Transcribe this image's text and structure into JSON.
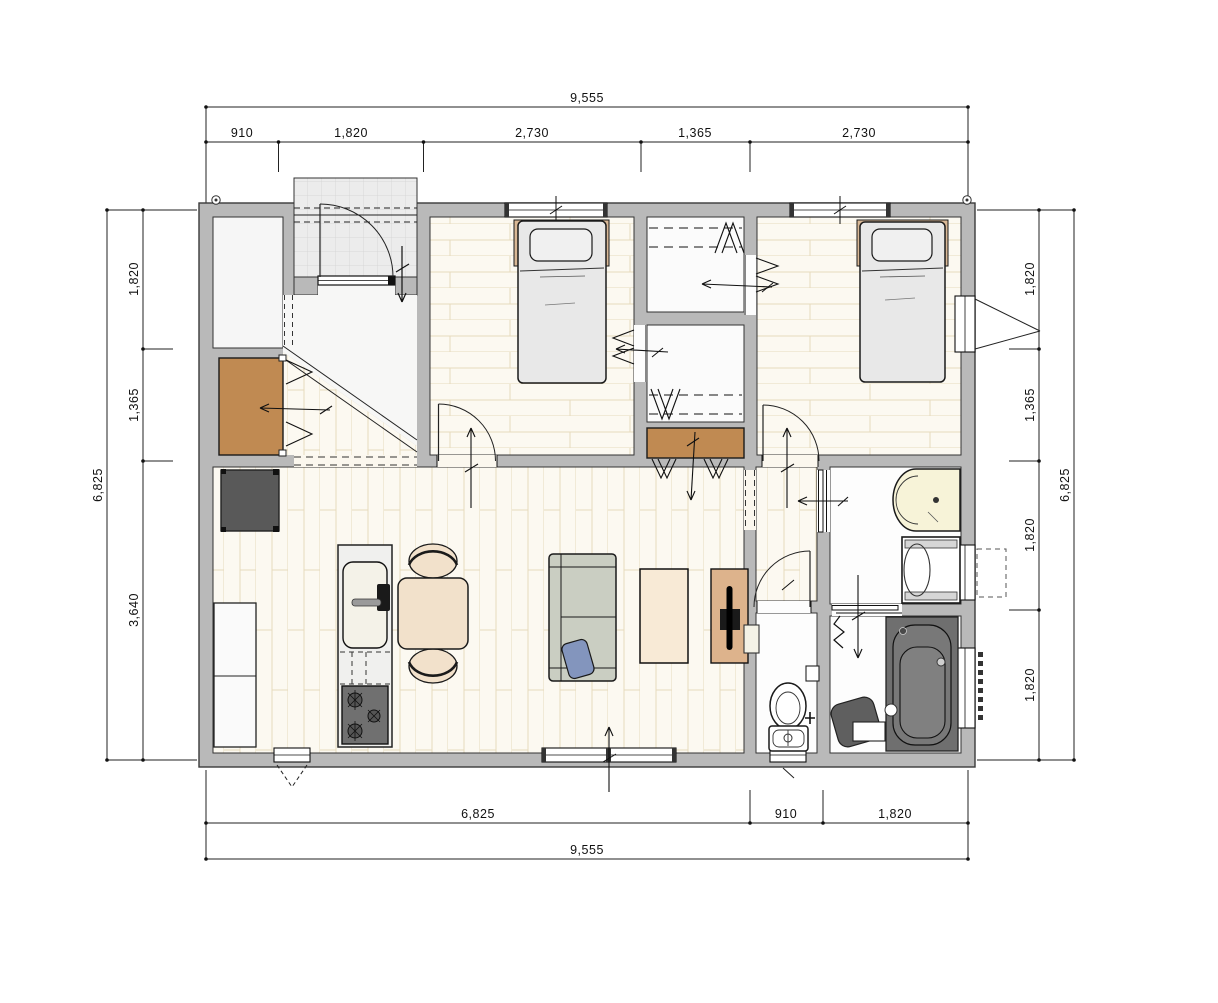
{
  "drawing": {
    "kind": "floor-plan",
    "units": "mm"
  },
  "dimensions": {
    "top": {
      "overall": "9,555",
      "segments": [
        "910",
        "1,820",
        "2,730",
        "1,365",
        "2,730"
      ]
    },
    "bottom": {
      "overall": "9,555",
      "segments": [
        "6,825",
        "910",
        "1,820"
      ]
    },
    "left": {
      "overall": "6,825",
      "segments": [
        "1,820",
        "1,365",
        "3,640"
      ]
    },
    "right": {
      "overall": "6,825",
      "segments": [
        "1,820",
        "1,365",
        "1,820",
        "1,820"
      ]
    }
  },
  "rooms": [
    "entrance-porch",
    "genkan",
    "shoe-in-closet",
    "bedroom-west",
    "bedroom-east",
    "closet-north",
    "closet-south",
    "hall-cabinet",
    "ldk",
    "hall-east",
    "toilet-room",
    "washroom",
    "bathroom"
  ],
  "furniture": [
    "single-bed-west",
    "single-bed-east",
    "refrigerator",
    "kitchen-counter",
    "kitchen-island-sink",
    "gas-stove",
    "dining-table",
    "dining-chairs",
    "sofa",
    "cushion",
    "coffee-table",
    "tv-board",
    "television",
    "vanity-basin",
    "washing-machine",
    "bathtub",
    "shower-stool",
    "toilet",
    "paper-holder"
  ],
  "colors": {
    "wall": "#b9b9b9",
    "line": "#1a1a1a",
    "tile": "#ececec",
    "floor_wood": "#fcf9f1",
    "floor_line": "#e6dabd",
    "closet_brown": "#c08a52",
    "appliance_dark": "#595959",
    "bath_gray": "#6f6f6f",
    "bed": "#e8e8e8",
    "bed_frame": "#d9b896",
    "sofa": "#cacec2",
    "cushion_blue": "#8395bd",
    "table_beige": "#f2e1cb",
    "tv_board": "#ddb38c",
    "vanity_cream": "#f7f3d8",
    "stove_gray": "#707070"
  }
}
